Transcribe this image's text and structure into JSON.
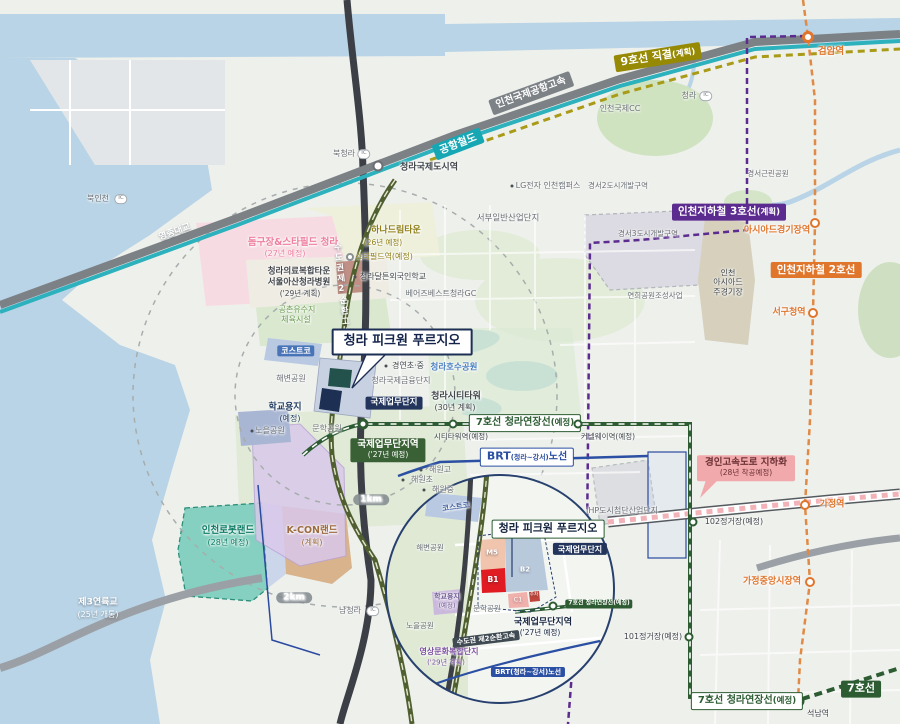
{
  "badges": {
    "line9_main": "9호선 직결",
    "line9_sub": "(계획)",
    "airport_rail": "공항철도",
    "airport_expwy": "인천국제공항고속",
    "yeongjong_bridge": "영종대교",
    "line3_main": "인천지하철 3호선",
    "line3_sub": "(계획)",
    "line2": "인천지하철 2호선",
    "line7ext_main": "7호선 청라연장선",
    "line7ext_sub": "(예정)",
    "line7": "7호선",
    "brt_1": "BRT",
    "brt_2": "(청라~강서)",
    "brt_3": "노선",
    "brt_small": "BRT(청라~강서)노선",
    "gyeongin_l1": "경인고속도로 지하화",
    "gyeongin_l2": "(28년 착공예정)",
    "main_title": "청라 피크원 푸르지오",
    "ibd": "국제업무단지",
    "ibd_station_l1": "국제업무단지역",
    "ibd_station_l2": "('27년 예정)",
    "srg_badge": "수도권 제2순환고속",
    "srg_road": "수도권제2순환고속"
  },
  "stations": {
    "geomam": "검암역",
    "cheongna_intl": "청라국제도시역",
    "starfield": "스타필드역(예정)",
    "citytower": "시티타워역(예정)",
    "canalway": "커넬웨이역(예정)",
    "asiad": "아시아드경기장역",
    "seogucheong": "서구청역",
    "gajeong": "가정역",
    "s102": "102정거장(예정)",
    "gajeong_market": "가정중앙시장역",
    "s101": "101정거장(예정)",
    "seoknam": "석남역"
  },
  "ic": {
    "label_ic": "IC",
    "cheongna": "청라",
    "bukcheongna": "북청라",
    "bukincheon": "북인천",
    "namcheongna": "남청라"
  },
  "places": {
    "incheon_cc": "인천국제CC",
    "lg": "LG전자 인천캠퍼스",
    "gs2": "경서2도시개발구역",
    "gs3": "경서3도시개발구역",
    "gs_park": "경서근린공원",
    "seobu": "서부일반산업단지",
    "hana_l1": "하나드림타운",
    "hana_l2": "(26년 예정)",
    "dalton": "청라달튼외국인학교",
    "bears": "베어즈베스트청라GC",
    "dome_l1": "돔구장&스타필드 청라",
    "dome_l2": "(27년 예정)",
    "medical_l1": "청라의료복합타운",
    "medical_l2": "서울아산청라병원",
    "medical_l3": "('29년 계획)",
    "gongchon_l1": "공촌유수지",
    "gongchon_l2": "체육시설",
    "costco": "코스트코",
    "haebyeon": "해변공원",
    "lake_park": "청라호수공원",
    "finance": "청라국제금융단지",
    "gyeongyeon": "경연초·중",
    "citytower_l1": "청라시티타워",
    "citytower_l2": "(30년 계획)",
    "school_l1": "학교용지",
    "school_l2": "(예정)",
    "noeul": "노을공원",
    "munhak": "문학공원",
    "yeongsang_l1": "영상문화복합단지",
    "yeongsang_l2": "('29년 계획)",
    "haewon_go": "해원고",
    "haewon_cho": "해원초",
    "haewon_jung": "해원중",
    "robot_l1": "인천로봇랜드",
    "robot_l2": "(28년 예정)",
    "kcon_l1": "K-CON랜드",
    "kcon_l2": "(계획)",
    "bridge3_l1": "제3연륙교",
    "bridge3_l2": "(25년 개통)",
    "yeonhui": "연희공원조성사업",
    "stadium_l1": "인천",
    "stadium_l2": "아시아드",
    "stadium_l3": "주경기장",
    "ihp": "IHP도시첨단산업단지"
  },
  "inset": {
    "m5": "M5",
    "b1": "B1",
    "b2": "B2",
    "c1": "C1",
    "parking": "주차"
  },
  "scale": {
    "km1": "1km",
    "km2": "2km"
  }
}
